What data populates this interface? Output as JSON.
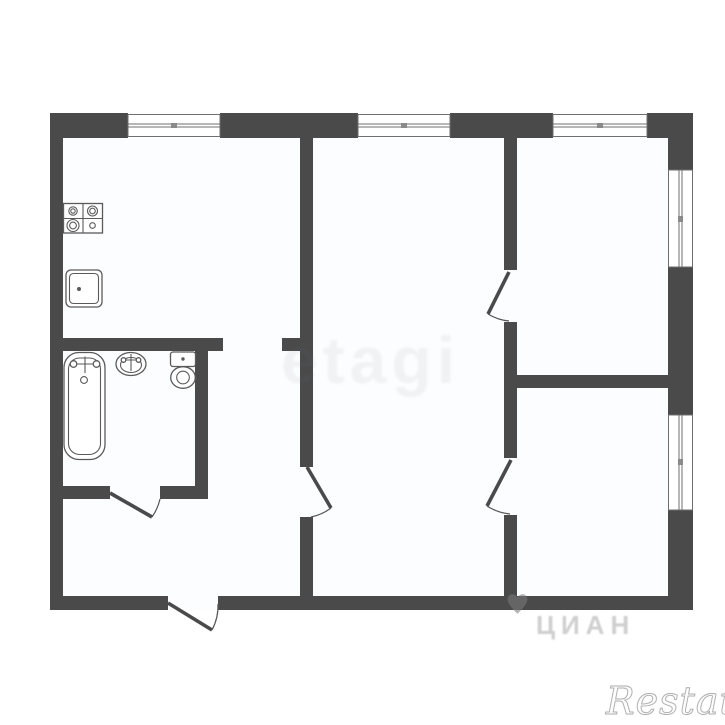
{
  "title": "Apartment floor plan",
  "colors": {
    "wall": "#4a4a4a",
    "background": "#ffffff",
    "room_fill": "#fcfdfe",
    "fixture_stroke": "#5a5a5a",
    "window_frame": "#6f6f6f"
  },
  "watermarks": {
    "center": {
      "text": "etagi"
    },
    "cian": {
      "text": "ЦИАН",
      "icon": "heart-icon"
    },
    "brand": {
      "text": "Restate"
    }
  },
  "plan": {
    "fixtures": [
      {
        "name": "stove",
        "location": "kitchen"
      },
      {
        "name": "kitchen-sink",
        "location": "kitchen"
      },
      {
        "name": "bathtub",
        "location": "bathroom"
      },
      {
        "name": "wash-basin",
        "location": "bathroom"
      },
      {
        "name": "toilet",
        "location": "bathroom"
      }
    ],
    "windows": [
      {
        "wall": "top",
        "count": 3
      },
      {
        "wall": "right",
        "count": 2
      }
    ],
    "doors": [
      {
        "type": "entrance",
        "wall": "bottom"
      },
      {
        "type": "interior",
        "between": "hall-bathroom"
      },
      {
        "type": "interior",
        "between": "hall-middle-room"
      },
      {
        "type": "interior",
        "between": "middle-room-top-right-room"
      },
      {
        "type": "interior",
        "between": "middle-room-bottom-right-room"
      }
    ],
    "openings": [
      {
        "type": "doorless-passage",
        "between": "kitchen-hall"
      }
    ]
  }
}
